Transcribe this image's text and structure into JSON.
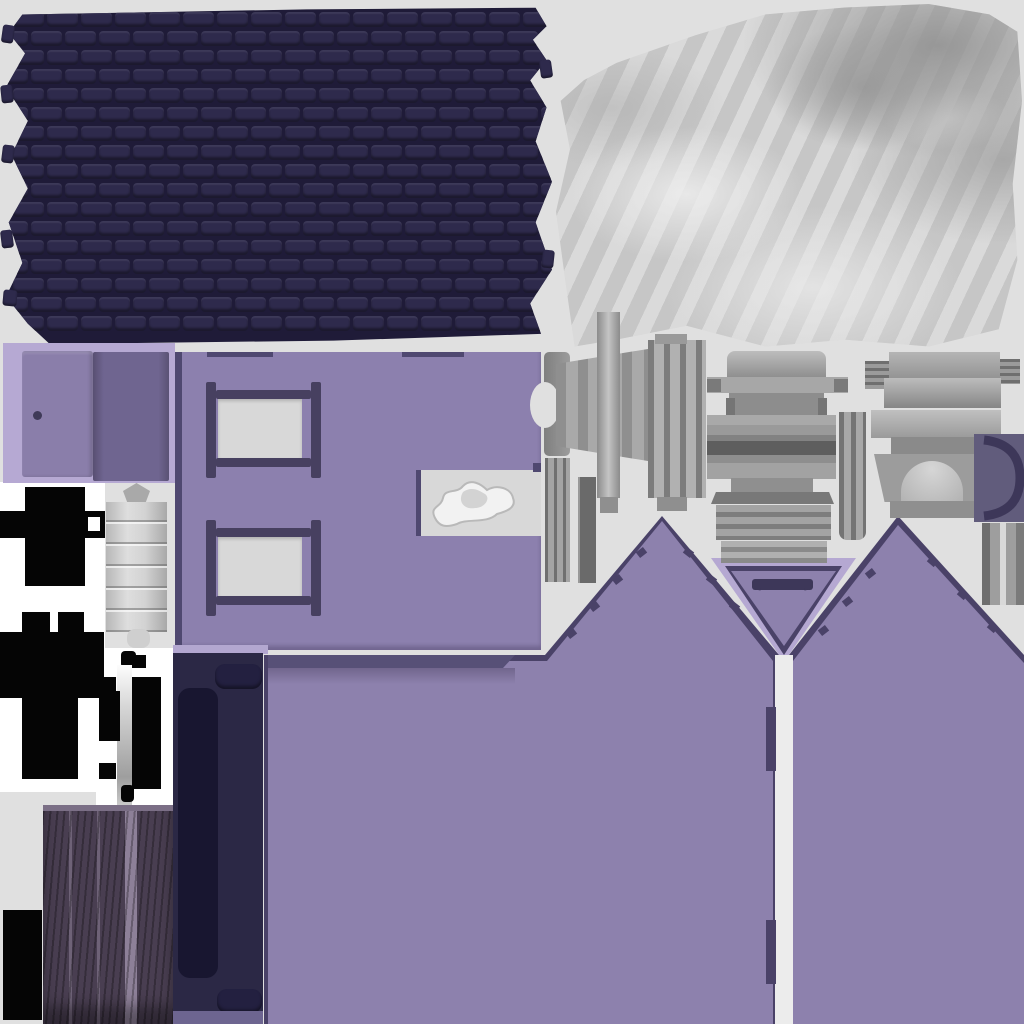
{
  "canvas": {
    "width": 1024,
    "height": 1024
  },
  "description": "Baked texture atlas sheet (UV islands) for a low-poly house 3D asset; no text content, geometry pieces only",
  "palette": {
    "bg": "#e0e0e0",
    "white": "#ffffff",
    "whiteStrip": "#ececec",
    "roofTile": "#2e2a4c",
    "roofGap": "#1f1b38",
    "clothBase": "#cfcfcf",
    "doorPanelBg": "#b6a9d3",
    "doorLeft": "#8a7eaa",
    "doorRight": "#6f6590",
    "doorKnob": "#3f3a58",
    "wall": "#8c80ae",
    "wall2": "#8d81ad",
    "wallEdgeDark": "#4f4870",
    "windowFrame": "#474060",
    "windowPane": "#d8d8d8",
    "eaveDark": "#575077",
    "lavender": "#b5a8d2",
    "gableOutline": "#4a4268",
    "archDark": "#3d3759",
    "navyPanel": "#2b2845",
    "navyInner": "#181630",
    "navyPill": "#232040",
    "navyTopStrip": "#b3a7d0",
    "navyBottomStrip": "#6d6590",
    "blackPiece": "#050505",
    "silverDark": "#a9a9a9",
    "woodBase": "#493e51",
    "woodLight": "#6e6277",
    "woodGap": "#8d8098",
    "cSquareBg": "#615c7c",
    "smoke": "#f2f2f2",
    "smokeShade": "#b9b9b9"
  },
  "atlas": {
    "roof": {
      "label": "roof-shingle-sheet",
      "rows": 17,
      "cols": 17
    },
    "cloth": {
      "label": "draped-cloth-bake"
    },
    "doorPanel": {
      "label": "front-door-faces"
    },
    "wallWindows": {
      "label": "side-wall-with-two-windows-and-notch"
    },
    "smoke": {
      "label": "smoke-puff-bake"
    },
    "blackParts": {
      "label": "unlit-black-interior-parts"
    },
    "cylinder": {
      "label": "rolled-metal-column"
    },
    "hinge": {
      "label": "metal-hinge-with-pin"
    },
    "woodDoor": {
      "label": "wood-plank-shutter"
    },
    "navyPanel": {
      "label": "roof-ridge-panel"
    },
    "purpleWalls": {
      "label": "gabled-end-walls-with-arch-vent"
    },
    "grayParts": {
      "label": "chimney-fireplace-and-trim-parts"
    }
  }
}
